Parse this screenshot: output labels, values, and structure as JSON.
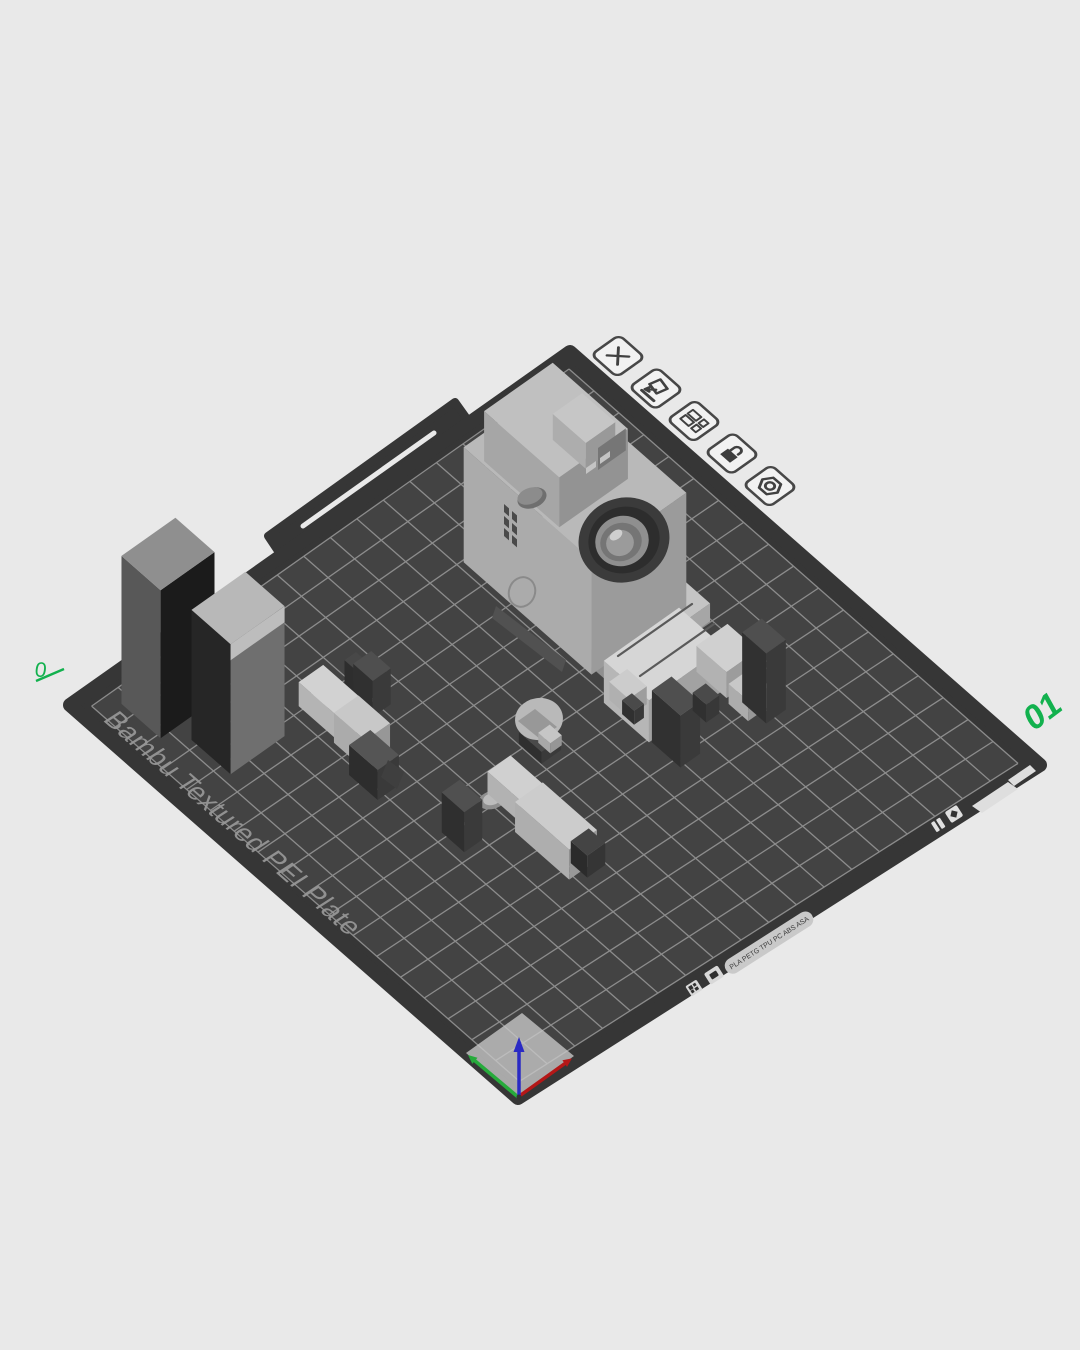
{
  "colors": {
    "background": "#e9e9e9",
    "plate_edge": "#363636",
    "plate_surface": "#434343",
    "grid_line": "#9d9d9d",
    "plate_text": "#969696",
    "accent_green": "#12b14e",
    "axis_x": "#b41717",
    "axis_y": "#27ab3c",
    "axis_z": "#2a2ac4",
    "model_light": "#bababa",
    "support_dark": "#3a3a3a",
    "toolbar_stroke": "#474747"
  },
  "plate": {
    "surface_label": "Bambu Textured PEI Plate",
    "number": "01",
    "corner_mark": "0",
    "edge_text": "PLA PETG TPU PC ABS ASA"
  },
  "plate_toolbar": {
    "items": [
      {
        "name": "delete-plate-button",
        "icon": "x-icon"
      },
      {
        "name": "auto-orient-plate-button",
        "icon": "orient-arrow-icon"
      },
      {
        "name": "arrange-plate-button",
        "icon": "arrange-icon"
      },
      {
        "name": "lock-plate-button",
        "icon": "lock-icon"
      },
      {
        "name": "plate-settings-button",
        "icon": "gear-icon"
      }
    ]
  },
  "models": [
    {
      "name": "prime-tower"
    },
    {
      "name": "camera-model"
    },
    {
      "name": "robot-body-model"
    },
    {
      "name": "robot-arm-left-model"
    },
    {
      "name": "robot-head-model"
    },
    {
      "name": "robot-arm-front-model"
    }
  ]
}
